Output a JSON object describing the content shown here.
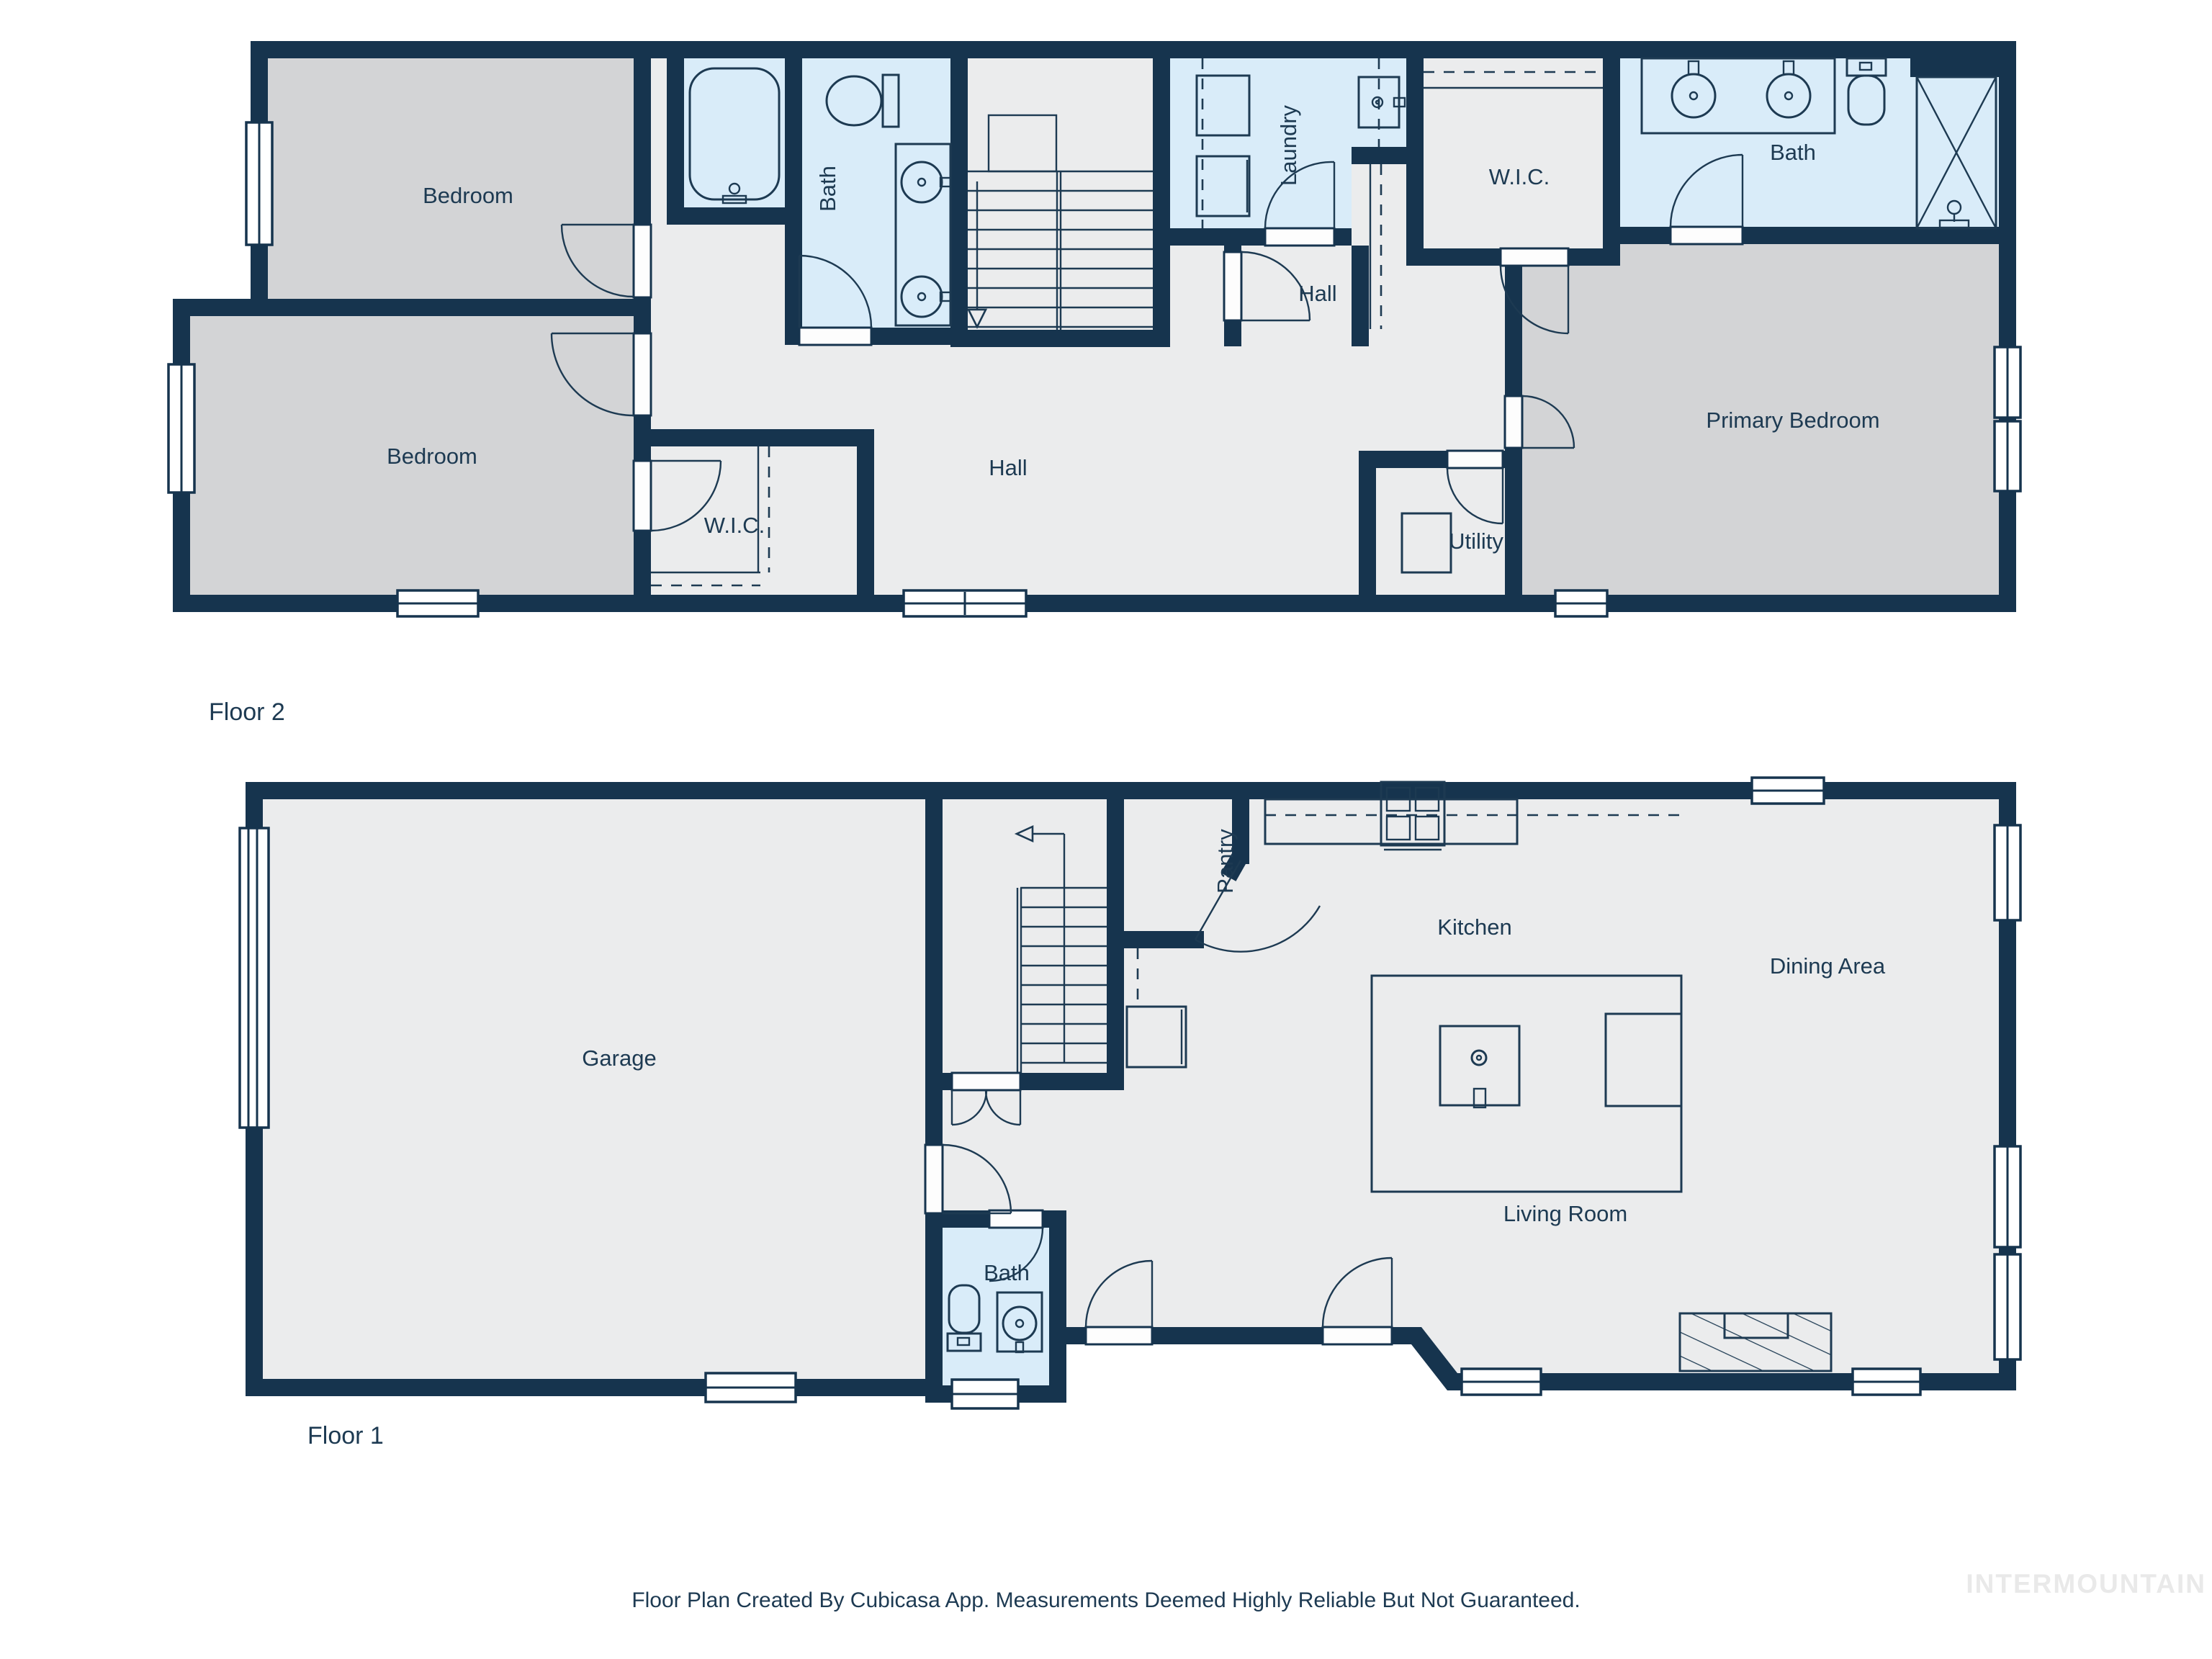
{
  "colors": {
    "wall": "#16344e",
    "floor": "#ebeced",
    "bedroom_floor": "#d3d4d6",
    "wet_room_floor": "#d9ecf9",
    "label_text": "#1d3a52",
    "watermark_text": "#e9e9e9",
    "background": "#ffffff"
  },
  "floor2": {
    "label": "Floor 2",
    "rooms": {
      "bedroom1": "Bedroom",
      "bedroom2": "Bedroom",
      "bath_left": "Bath",
      "hall": "Hall",
      "hall_small": "Hall",
      "laundry": "Laundry",
      "wic_left": "W.I.C.",
      "wic_right": "W.I.C.",
      "bath_right": "Bath",
      "primary_bedroom": "Primary Bedroom",
      "utility": "Utility"
    }
  },
  "floor1": {
    "label": "Floor 1",
    "rooms": {
      "garage": "Garage",
      "pantry": "Pantry",
      "kitchen": "Kitchen",
      "dining": "Dining Area",
      "living": "Living Room",
      "bath": "Bath"
    }
  },
  "footer": {
    "disclaimer": "Floor Plan Created By Cubicasa App. Measurements Deemed Highly Reliable But Not Guaranteed."
  },
  "watermark": "INTERMOUNTAIN"
}
